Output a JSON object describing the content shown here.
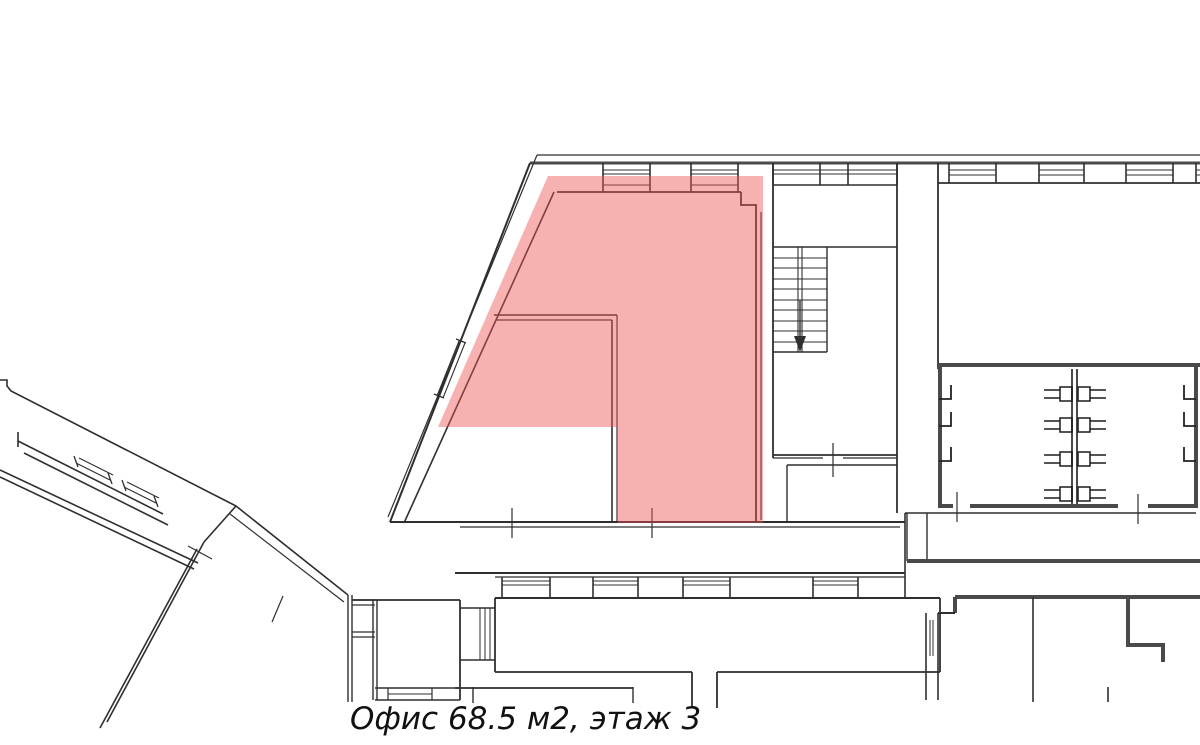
{
  "page": {
    "background": "#ffffff"
  },
  "caption": {
    "text": "Офис 68.5 м2, этаж 3",
    "area_m2": "68.5",
    "floor": "3"
  },
  "plan": {
    "highlight": {
      "color": "#ee5252",
      "opacity": 0.45,
      "label": "highlighted office area"
    },
    "wall_color": "#2f2f2f",
    "heavy_wall_color": "#4a4a4a",
    "background": "#ffffff"
  }
}
